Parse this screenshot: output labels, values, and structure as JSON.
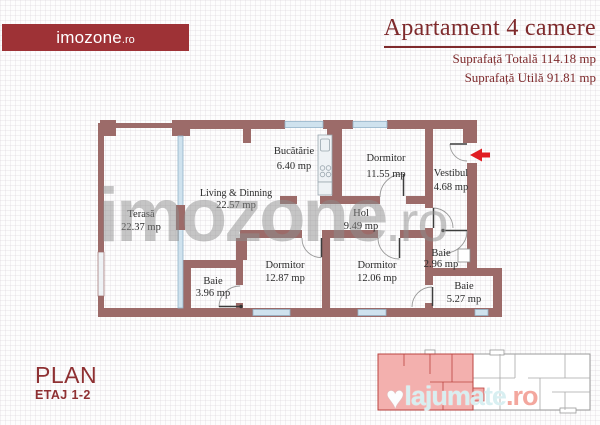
{
  "brand": {
    "logo_text": "imozone",
    "logo_suffix": ".ro"
  },
  "header": {
    "title": "Apartament 4 camere",
    "surface_total": "Suprafață Totală 114.18 mp",
    "surface_util": "Suprafață Utilă 91.81 mp"
  },
  "rooms": [
    {
      "name": "Bucătărie",
      "area": "6.40 mp"
    },
    {
      "name": "Dormitor",
      "area": "11.55 mp"
    },
    {
      "name": "Vestibul",
      "area": "4.68 mp"
    },
    {
      "name": "Living & Dinning",
      "area": "22.57 mp"
    },
    {
      "name": "Terasă",
      "area": "22.37 mp"
    },
    {
      "name": "Hol",
      "area": "9.49 mp"
    },
    {
      "name": "Dormitor",
      "area": "12.87 mp"
    },
    {
      "name": "Dormitor",
      "area": "12.06 mp"
    },
    {
      "name": "Baie",
      "area": "3.96 mp"
    },
    {
      "name": "Baie",
      "area": "2.96 mp"
    },
    {
      "name": "Baie",
      "area": "5.27 mp"
    }
  ],
  "footer": {
    "plan_label": "PLAN",
    "floor_label": "ETAJ 1-2"
  },
  "watermarks": {
    "main": "imozone",
    "main_suffix": ".ro",
    "classified": "lajumate",
    "classified_suffix": ".ro",
    "heart_icon": "♥"
  },
  "colors": {
    "brand_red": "#9e3236",
    "title_maroon": "#7e2a2c",
    "wall_brown": "#9c6b69",
    "window_blue": "#cfe2ee",
    "highlight_pink": "#f2a7a5",
    "arrow_red": "#e01d22",
    "watermark_gray": "#8e8e8e"
  }
}
